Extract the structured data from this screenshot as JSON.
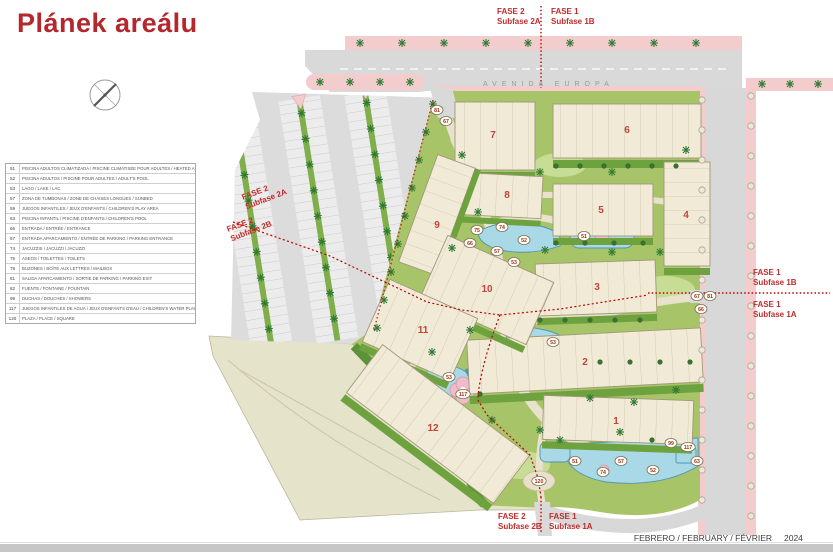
{
  "title": "Plánek areálu",
  "legend": {
    "rows": [
      {
        "num": "51",
        "desc": "PISCINA ADULTOS CLIMATIZADA / PISCINE CLIMATISÉE POUR ADULTES / HEATED ADULT'S POOL"
      },
      {
        "num": "52",
        "desc": "PISCINA ADULTOS / PISCINE POUR ADULTES / ADULT'S POOL"
      },
      {
        "num": "53",
        "desc": "LAGO / LAKE / LAC"
      },
      {
        "num": "57",
        "desc": "ZONA DE TUMBONAS / ZONE DE CHAISES LONGUES / SUNBED"
      },
      {
        "num": "59",
        "desc": "JUEGOS INFANTILES / JEUX D'ENFANTS / CHILDREN'S PLAY AREA"
      },
      {
        "num": "63",
        "desc": "PISCINA INFANTIL / PISCINE D'ENFANTS / CHILDREN'S POOL"
      },
      {
        "num": "66",
        "desc": "ENTRADA / ENTRÉE / ENTRANCE"
      },
      {
        "num": "67",
        "desc": "ENTRADA APARCAMIENTO / ENTRÉE DE PARKING / PARKING ENTRANCE"
      },
      {
        "num": "74",
        "desc": "JACUZZIS / JACUZZI / JACUZZI"
      },
      {
        "num": "75",
        "desc": "ASEOS / TOILETTES / TOILETS"
      },
      {
        "num": "78",
        "desc": "BUZONES / BOÎTE AUX LETTRES / MAILBOX"
      },
      {
        "num": "81",
        "desc": "SALIDA APARCAMIENTO / SORTIE DE PARKING / PARKING EXIT"
      },
      {
        "num": "82",
        "desc": "FUENTE / FONTAINE / FOUNTAIN"
      },
      {
        "num": "99",
        "desc": "DUCHAS / DOUCHES / SHOWERS"
      },
      {
        "num": "117",
        "desc": "JUEGOS INFANTILES DE AGUA / JEUX D'ENFANTS D'EAU / CHILDREN'S WATER PLAY AREA"
      },
      {
        "num": "120",
        "desc": "PLAZA / PLACE / SQUARE"
      }
    ]
  },
  "streets": {
    "avenida": "AVENIDA EUROPA",
    "calle": "CALLE PARIS"
  },
  "phases": {
    "top_left": {
      "l1": "FASE 2",
      "l2": "Subfase 2A"
    },
    "top_right": {
      "l1": "FASE 1",
      "l2": "Subfase 1B"
    },
    "mid_left_upper": {
      "l1": "FASE 2",
      "l2": "Subfase 2A"
    },
    "mid_left_lower": {
      "l1": "FASE 2",
      "l2": "Subfase 2B"
    },
    "right_upper": {
      "l1": "FASE 1",
      "l2": "Subfase 1B"
    },
    "right_lower": {
      "l1": "FASE 1",
      "l2": "Subfase 1A"
    },
    "bottom_left": {
      "l1": "FASE 2",
      "l2": "Subfase 2B"
    },
    "bottom_right": {
      "l1": "FASE 1",
      "l2": "Subfase 1A"
    }
  },
  "map": {
    "buildings": [
      {
        "n": "1",
        "x": 616,
        "y": 424
      },
      {
        "n": "2",
        "x": 585,
        "y": 365
      },
      {
        "n": "3",
        "x": 597,
        "y": 290
      },
      {
        "n": "4",
        "x": 686,
        "y": 218
      },
      {
        "n": "5",
        "x": 601,
        "y": 213
      },
      {
        "n": "6",
        "x": 627,
        "y": 133
      },
      {
        "n": "7",
        "x": 493,
        "y": 138
      },
      {
        "n": "8",
        "x": 507,
        "y": 198
      },
      {
        "n": "9",
        "x": 437,
        "y": 228
      },
      {
        "n": "10",
        "x": 487,
        "y": 292
      },
      {
        "n": "11",
        "x": 423,
        "y": 333
      },
      {
        "n": "12",
        "x": 433,
        "y": 431
      }
    ],
    "markers": [
      {
        "n": "81",
        "x": 437,
        "y": 110
      },
      {
        "n": "67",
        "x": 446,
        "y": 121
      },
      {
        "n": "75",
        "x": 477,
        "y": 230
      },
      {
        "n": "74",
        "x": 502,
        "y": 227
      },
      {
        "n": "66",
        "x": 470,
        "y": 243
      },
      {
        "n": "57",
        "x": 497,
        "y": 251
      },
      {
        "n": "52",
        "x": 524,
        "y": 240
      },
      {
        "n": "51",
        "x": 584,
        "y": 236
      },
      {
        "n": "53",
        "x": 514,
        "y": 262
      },
      {
        "n": "53",
        "x": 553,
        "y": 342
      },
      {
        "n": "53",
        "x": 449,
        "y": 377
      },
      {
        "n": "117",
        "x": 463,
        "y": 394
      },
      {
        "n": "120",
        "x": 539,
        "y": 481
      },
      {
        "n": "51",
        "x": 575,
        "y": 461
      },
      {
        "n": "57",
        "x": 621,
        "y": 461
      },
      {
        "n": "74",
        "x": 603,
        "y": 472
      },
      {
        "n": "52",
        "x": 653,
        "y": 470
      },
      {
        "n": "99",
        "x": 671,
        "y": 443
      },
      {
        "n": "117",
        "x": 688,
        "y": 447
      },
      {
        "n": "63",
        "x": 697,
        "y": 461
      },
      {
        "n": "67",
        "x": 697,
        "y": 296
      },
      {
        "n": "81",
        "x": 710,
        "y": 296
      },
      {
        "n": "66",
        "x": 701,
        "y": 309
      }
    ]
  },
  "footer": {
    "date_label": "FEBRERO / FEBRUARY / FÉVRIER",
    "year": "2024"
  },
  "colors": {
    "accent_red": "#c00000",
    "title_red": "#b3282d",
    "pool_blue": "#a9d8e6",
    "site_green": "#a8c468",
    "sidewalk_pink": "#f3cdcd",
    "road_gray": "#d9d9d9"
  }
}
